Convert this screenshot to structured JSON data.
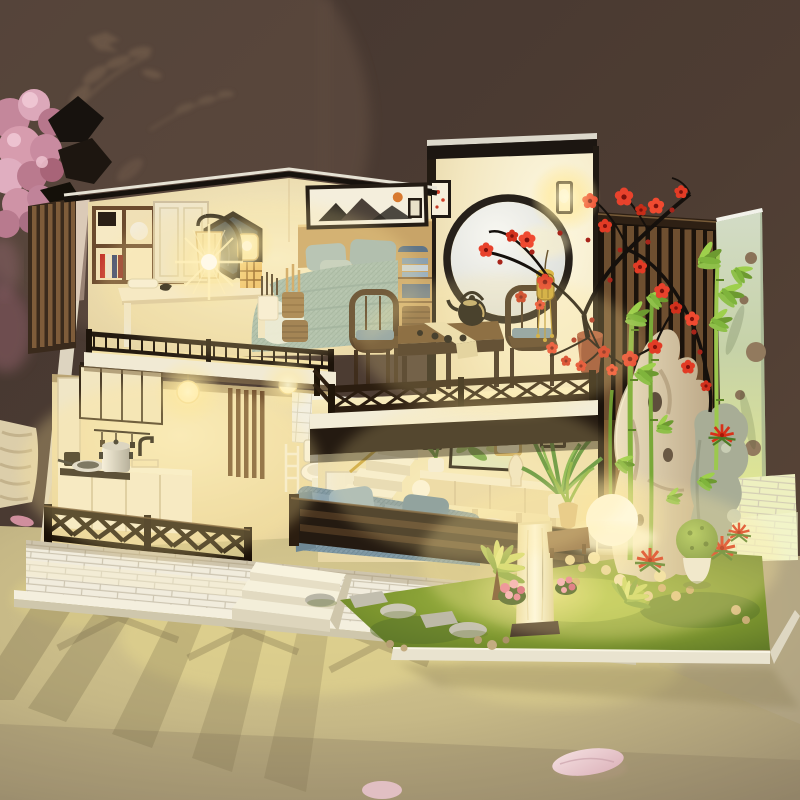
{
  "scene": {
    "type": "photograph",
    "subject": "Illuminated DIY miniature dollhouse (two-story Japanese-style loft house with LED lights)",
    "setting": "Model displayed on a cream table against a dark warm brown wall with faint leaf-print curtain shadows",
    "lighting": "Warm interior LED glow, lamp starbursts, long lattice shadows cast on the table",
    "no_visible_text": true
  },
  "palette": {
    "wall_brown": "#4c3a30",
    "table_gold": "#c9ba85",
    "warm_glow": "#ffedb0",
    "wood_dark": "#2b1d10",
    "wood_mid": "#7a5836",
    "cream_wall": "#f4e9c6",
    "brick_white": "#f1ecdd",
    "bedding_blue": "#9fb9b2",
    "sofa_blue": "#7d96a2",
    "cushion_blue": "#7e98a8",
    "blossom_red": "#e23b25",
    "bamboo_green": "#8fc04a",
    "grass_green": "#8aa838",
    "rock_tan": "#cbb89a",
    "panel_green": "#ccd6ae",
    "flower_pink": "#dfa3b2",
    "lantern_brass": "#c9a43a"
  },
  "objects": {
    "background": [
      "dark brown wall",
      "leaf and bird curtain silhouettes",
      "pink hydrangea flowers with dark leaves",
      "beige knit blanket at left edge"
    ],
    "foreground": [
      "cream display table",
      "lattice light shadows",
      "fallen pink petals"
    ],
    "bedroom_loft": [
      "bookshelf with white sphere and books",
      "wardrobe door",
      "hexagonal mirror",
      "desk with glowing arc lamp",
      "pleated shade starburst",
      "cube lantern",
      "pencil and brush cups",
      "rattan basket",
      "blue knit bed with pillows",
      "white crane motif blanket",
      "framed mountain art",
      "wall lamp",
      "nightstand with towels and basket",
      "slat privacy screen",
      "baluster railing"
    ],
    "tea_room": [
      "round moon window",
      "blue ink mountain painting with red sun",
      "glowing wall sconce",
      "framed flower lamp",
      "dark wood tea table with runner",
      "black iron teapot",
      "black teacups",
      "two dark wood chairs with blue cushions",
      "brass hanging lantern with tassel",
      "terracotta pot with red plum blossom tree",
      "X-lattice balcony railing"
    ],
    "kitchen": [
      "upper cabinets",
      "utensil rail",
      "stove with pressure cooker and frying pan",
      "black faucet and sink",
      "two glowing pendant bulbs",
      "wood slat partition",
      "dining table with steel pot and food",
      "four white arch-back chairs with blue cushions"
    ],
    "bathroom": [
      "white tile wall",
      "toilet",
      "toilet paper roll",
      "red cup",
      "white rack"
    ],
    "living_room": [
      "stairs with storage boxes",
      "brass handrail",
      "hanging scroll lanterns",
      "glowing white lantern",
      "framed green bamboo art",
      "cream console with vases and aloe pot",
      "glowing orb lamp",
      "large potted plant",
      "blue knit sofa with pillows",
      "white ottoman",
      "dark slat balustrade"
    ],
    "garden": [
      "green moss grass",
      "stepping stones",
      "pebbles",
      "glowing pillar lamp",
      "bright light orb",
      "potted grass on wood stand",
      "palm plants",
      "pink flower bushes",
      "red bromeliads",
      "moss ball topiary in white pot",
      "tan scholar rock with holes",
      "gray rock",
      "bamboo stalks and leaves",
      "dark vertical slat screen",
      "pale perforated panel",
      "lit white brick wall"
    ],
    "base": [
      "white brick foundation",
      "white plinth",
      "three front steps",
      "dark X-lattice railings"
    ]
  }
}
